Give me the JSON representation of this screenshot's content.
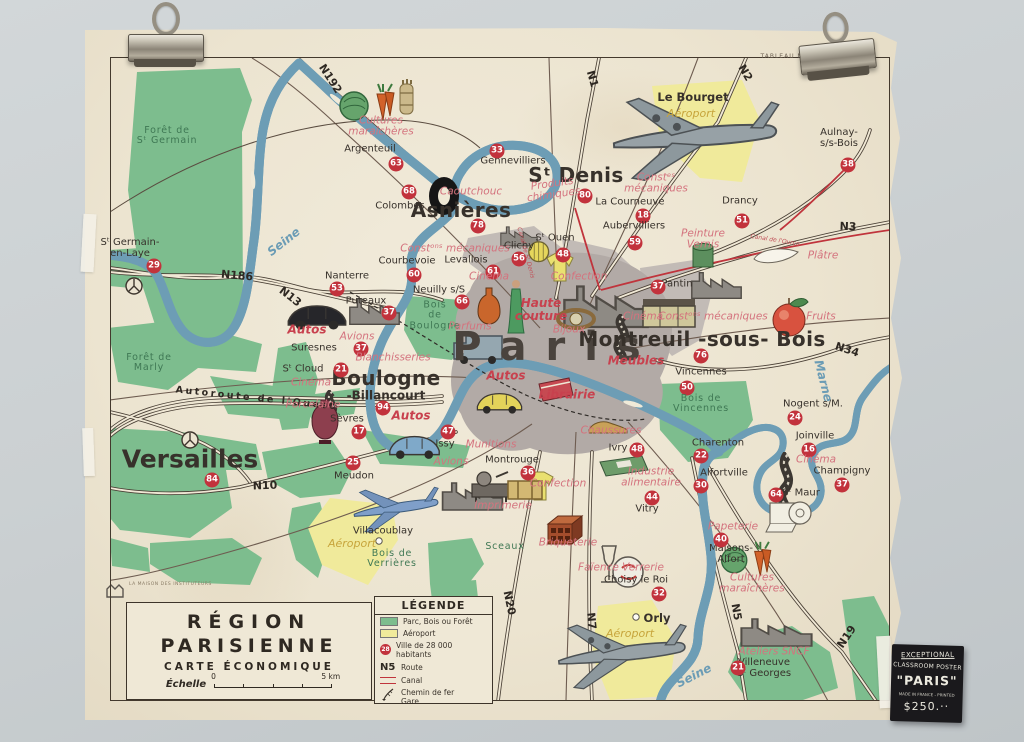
{
  "scene": {
    "wall_color": "#cbd0d2"
  },
  "poster": {
    "print_ref": "TABLEAU N° 22 —",
    "publisher": {
      "logo": "MDI",
      "name": "LA MAISON DES INSTITUTEURS"
    },
    "title_block": {
      "line1": "RÉGION",
      "line2": "PARISIENNE",
      "line3": "CARTE ÉCONOMIQUE",
      "scale_label": "Échelle",
      "scale_start": "0",
      "scale_end": "5 km"
    },
    "legend": {
      "title": "LÉGENDE",
      "park": "Parc, Bois ou Forêt",
      "airport": "Aéroport",
      "city_number": "28",
      "city": "Ville de 28 000 habitants",
      "route_symbol": "N5",
      "route": "Route",
      "canal": "Canal",
      "railway": "Chemin de fer",
      "station": "Gare"
    },
    "colors": {
      "park": "#7dbd8e",
      "airport": "#f0ea9b",
      "river": "#93c2d6",
      "canal": "#c0343c",
      "city_circle": "#c2323c",
      "industry_text": "#d4737e",
      "urban": "#b2aaa6"
    }
  },
  "price_tag": {
    "line1": "EXCEPTIONAL",
    "line2": "CLASSROOM POSTER",
    "line3": "\"PARIS\"",
    "line4": "MADE IN FRANCE - PRINTED",
    "line5": "$250.··"
  },
  "map": {
    "paris": "Paris",
    "cities": [
      {
        "name": "Versailles",
        "num": "84",
        "x": 190,
        "y": 459,
        "nx": 212,
        "ny": 480,
        "k": "xl"
      },
      {
        "name": "Asnières",
        "num": "78",
        "x": 461,
        "y": 211,
        "nx": 478,
        "ny": 226,
        "k": "lg"
      },
      {
        "name": "Sᵗ Denis",
        "num": "80",
        "x": 576,
        "y": 176,
        "nx": 585,
        "ny": 196,
        "k": "lg"
      },
      {
        "name": "Boulogne",
        "num": "94",
        "x": 386,
        "y": 379,
        "nx": 383,
        "ny": 408,
        "k": "lg"
      },
      {
        "name": "-Billancourt",
        "num": "",
        "x": 386,
        "y": 396,
        "nx": 0,
        "ny": 0,
        "k": "mdb"
      },
      {
        "name": "Montreuil -sous- Bois",
        "num": "76",
        "x": 702,
        "y": 340,
        "nx": 701,
        "ny": 356,
        "k": "lg"
      },
      {
        "name": "Le Bourget",
        "num": "",
        "x": 693,
        "y": 97,
        "nx": 0,
        "ny": 0,
        "k": "smb"
      },
      {
        "name": "Orly",
        "num": "",
        "x": 657,
        "y": 618,
        "nx": 0,
        "ny": 0,
        "k": "smb"
      },
      {
        "name": "Villacoublay",
        "num": "",
        "x": 383,
        "y": 532,
        "nx": 0,
        "ny": 0,
        "k": "sm"
      },
      {
        "name": "Argenteuil",
        "num": "63",
        "x": 370,
        "y": 150,
        "nx": 396,
        "ny": 164,
        "k": "sm"
      },
      {
        "name": "Colombes",
        "num": "68",
        "x": 400,
        "y": 207,
        "nx": 409,
        "ny": 192,
        "k": "sm"
      },
      {
        "name": "Gennevilliers",
        "num": "33",
        "x": 513,
        "y": 162,
        "nx": 497,
        "ny": 151,
        "k": "sm"
      },
      {
        "name": "La Courneuve",
        "num": "18",
        "x": 630,
        "y": 203,
        "nx": 643,
        "ny": 216,
        "k": "sm"
      },
      {
        "name": "Drancy",
        "num": "51",
        "x": 740,
        "y": 202,
        "nx": 742,
        "ny": 221,
        "k": "sm"
      },
      {
        "name": "Aubervilliers",
        "num": "59",
        "x": 634,
        "y": 227,
        "nx": 635,
        "ny": 243,
        "k": "sm"
      },
      {
        "name": "Aulnay-\ns/s-Bois",
        "num": "38",
        "x": 839,
        "y": 139,
        "nx": 848,
        "ny": 165,
        "k": "sm"
      },
      {
        "name": "Clichy",
        "num": "56",
        "x": 519,
        "y": 247,
        "nx": 519,
        "ny": 259,
        "k": "sm"
      },
      {
        "name": "Sᵗ Ouen",
        "num": "48",
        "x": 555,
        "y": 239,
        "nx": 563,
        "ny": 255,
        "k": "sm"
      },
      {
        "name": "Levallois",
        "num": "61",
        "x": 466,
        "y": 261,
        "nx": 493,
        "ny": 272,
        "k": "sm"
      },
      {
        "name": "Neuilly s/S",
        "num": "66",
        "x": 439,
        "y": 291,
        "nx": 462,
        "ny": 302,
        "k": "sm"
      },
      {
        "name": "Courbevoie",
        "num": "60",
        "x": 407,
        "y": 262,
        "nx": 414,
        "ny": 275,
        "k": "sm"
      },
      {
        "name": "Nanterre",
        "num": "53",
        "x": 347,
        "y": 277,
        "nx": 337,
        "ny": 289,
        "k": "sm"
      },
      {
        "name": "Sᵗ Germain-\nen-Laye",
        "num": "29",
        "x": 130,
        "y": 249,
        "nx": 154,
        "ny": 266,
        "k": "sm"
      },
      {
        "name": "Puteaux",
        "num": "37",
        "x": 366,
        "y": 302,
        "nx": 389,
        "ny": 313,
        "k": "sm"
      },
      {
        "name": "Suresnes",
        "num": "37",
        "x": 314,
        "y": 349,
        "nx": 361,
        "ny": 349,
        "k": "sm"
      },
      {
        "name": "Sᵗ Cloud",
        "num": "21",
        "x": 303,
        "y": 370,
        "nx": 341,
        "ny": 370,
        "k": "sm"
      },
      {
        "name": "Sèvres",
        "num": "17",
        "x": 347,
        "y": 420,
        "nx": 359,
        "ny": 432,
        "k": "sm"
      },
      {
        "name": "Meudon",
        "num": "25",
        "x": 354,
        "y": 477,
        "nx": 353,
        "ny": 463,
        "k": "sm"
      },
      {
        "name": "Issy",
        "num": "47",
        "x": 445,
        "y": 445,
        "nx": 448,
        "ny": 432,
        "k": "sm"
      },
      {
        "name": "Montrouge",
        "num": "36",
        "x": 512,
        "y": 461,
        "nx": 528,
        "ny": 473,
        "k": "sm"
      },
      {
        "name": "Ivry",
        "num": "48",
        "x": 618,
        "y": 449,
        "nx": 637,
        "ny": 450,
        "k": "sm"
      },
      {
        "name": "Vitry",
        "num": "44",
        "x": 647,
        "y": 510,
        "nx": 652,
        "ny": 498,
        "k": "sm"
      },
      {
        "name": "Choisy le Roi",
        "num": "32",
        "x": 636,
        "y": 581,
        "nx": 659,
        "ny": 594,
        "k": "sm"
      },
      {
        "name": "Charenton",
        "num": "22",
        "x": 718,
        "y": 444,
        "nx": 701,
        "ny": 456,
        "k": "sm"
      },
      {
        "name": "Alfortville",
        "num": "30",
        "x": 724,
        "y": 474,
        "nx": 701,
        "ny": 486,
        "k": "sm"
      },
      {
        "name": "Maisons-\nAlfort",
        "num": "40",
        "x": 731,
        "y": 555,
        "nx": 721,
        "ny": 540,
        "k": "sm"
      },
      {
        "name": "Sᵗ Maur",
        "num": "64",
        "x": 801,
        "y": 494,
        "nx": 776,
        "ny": 495,
        "k": "sm"
      },
      {
        "name": "Joinville",
        "num": "16",
        "x": 815,
        "y": 437,
        "nx": 809,
        "ny": 450,
        "k": "sm"
      },
      {
        "name": "Champigny",
        "num": "37",
        "x": 842,
        "y": 472,
        "nx": 842,
        "ny": 485,
        "k": "sm"
      },
      {
        "name": "Nogent s/M.",
        "num": "24",
        "x": 813,
        "y": 405,
        "nx": 795,
        "ny": 418,
        "k": "sm"
      },
      {
        "name": "Vincennes",
        "num": "50",
        "x": 701,
        "y": 373,
        "nx": 687,
        "ny": 388,
        "k": "sm"
      },
      {
        "name": "Pantin",
        "num": "37",
        "x": 677,
        "y": 285,
        "nx": 658,
        "ny": 287,
        "k": "sm"
      },
      {
        "name": "Villeneuve\nSᵗ Georges",
        "num": "21",
        "x": 764,
        "y": 669,
        "nx": 738,
        "ny": 668,
        "k": "sm"
      }
    ],
    "labels": [
      {
        "t": "N192",
        "k": "road",
        "x": 330,
        "y": 79,
        "r": 57
      },
      {
        "t": "N1",
        "k": "road",
        "x": 592,
        "y": 79,
        "r": 74
      },
      {
        "t": "N2",
        "k": "road",
        "x": 745,
        "y": 73,
        "r": 60
      },
      {
        "t": "N3",
        "k": "road",
        "x": 848,
        "y": 227,
        "r": 2
      },
      {
        "t": "N186",
        "k": "road",
        "x": 237,
        "y": 276,
        "r": 5
      },
      {
        "t": "N13",
        "k": "road",
        "x": 290,
        "y": 297,
        "r": 38
      },
      {
        "t": "Autoroute  de  l'Ouest",
        "k": "roadw",
        "x": 256,
        "y": 399,
        "r": 6
      },
      {
        "t": "N10",
        "k": "road",
        "x": 265,
        "y": 486,
        "r": -2
      },
      {
        "t": "N34",
        "k": "road",
        "x": 847,
        "y": 350,
        "r": 18
      },
      {
        "t": "N20",
        "k": "road",
        "x": 509,
        "y": 603,
        "r": 78
      },
      {
        "t": "N7",
        "k": "road",
        "x": 591,
        "y": 621,
        "r": 84
      },
      {
        "t": "N5",
        "k": "road",
        "x": 736,
        "y": 612,
        "r": 80
      },
      {
        "t": "N19",
        "k": "road",
        "x": 847,
        "y": 637,
        "r": -56
      },
      {
        "t": "Seine",
        "k": "water",
        "x": 284,
        "y": 242,
        "r": -38
      },
      {
        "t": "Seine",
        "k": "water",
        "x": 694,
        "y": 676,
        "r": -27
      },
      {
        "t": "Marne",
        "k": "water",
        "x": 823,
        "y": 381,
        "r": 76
      },
      {
        "t": "Canal de l'Ourcq",
        "k": "canal",
        "x": 775,
        "y": 241,
        "r": 9
      },
      {
        "t": "Canal de Sᵗ Denis",
        "k": "canal",
        "x": 525,
        "y": 253,
        "r": 75
      },
      {
        "t": "Forêt de\nSᵗ Germain",
        "k": "forest",
        "x": 167,
        "y": 136,
        "r": 0
      },
      {
        "t": "Forêt de\nMarly",
        "k": "forest",
        "x": 149,
        "y": 363,
        "r": 0
      },
      {
        "t": "Bois\nde\nBoulogne",
        "k": "forest",
        "x": 435,
        "y": 316,
        "r": 0
      },
      {
        "t": "Bois de\nVincennes",
        "k": "forest",
        "x": 701,
        "y": 404,
        "r": 0
      },
      {
        "t": "Bois de\nVerrières",
        "k": "forest",
        "x": 392,
        "y": 559,
        "r": 0
      },
      {
        "t": "Sceaux",
        "k": "forest",
        "x": 505,
        "y": 547,
        "r": 0
      },
      {
        "t": "Aéroport",
        "k": "air",
        "x": 691,
        "y": 114,
        "r": 0
      },
      {
        "t": "Aéroport",
        "k": "air",
        "x": 352,
        "y": 544,
        "r": 0
      },
      {
        "t": "Aéroport",
        "k": "air",
        "x": 630,
        "y": 634,
        "r": 0
      },
      {
        "t": "Cultures\nmaraîchères",
        "k": "ind",
        "x": 381,
        "y": 127,
        "r": 0
      },
      {
        "t": "Caoutchouc",
        "k": "ind",
        "x": 471,
        "y": 192,
        "r": 0
      },
      {
        "t": "Produits\nchimiques",
        "k": "ind",
        "x": 553,
        "y": 190,
        "r": -8
      },
      {
        "t": "Constᵉˢ\nmécaniques",
        "k": "ind",
        "x": 656,
        "y": 184,
        "r": 0
      },
      {
        "t": "Peinture\nVernis",
        "k": "ind",
        "x": 703,
        "y": 240,
        "r": 0
      },
      {
        "t": "Plâtre",
        "k": "ind",
        "x": 823,
        "y": 256,
        "r": 0
      },
      {
        "t": "Constᵒⁿˢ mécaniques",
        "k": "ind",
        "x": 455,
        "y": 249,
        "r": 0
      },
      {
        "t": "Cinéma",
        "k": "ind",
        "x": 489,
        "y": 277,
        "r": 0
      },
      {
        "t": "Confection",
        "k": "ind",
        "x": 579,
        "y": 277,
        "r": 0
      },
      {
        "t": "Haute\ncouture",
        "k": "indb",
        "x": 541,
        "y": 310,
        "r": 0
      },
      {
        "t": "Bijoux",
        "k": "ind",
        "x": 569,
        "y": 330,
        "r": 0
      },
      {
        "t": "Parfums",
        "k": "ind",
        "x": 470,
        "y": 327,
        "r": 0
      },
      {
        "t": "Meubles",
        "k": "indb",
        "x": 636,
        "y": 361,
        "r": 0
      },
      {
        "t": "Cinéma",
        "k": "ind",
        "x": 643,
        "y": 317,
        "r": 0
      },
      {
        "t": "Constᵒⁿˢ mécaniques",
        "k": "ind",
        "x": 713,
        "y": 317,
        "r": 0
      },
      {
        "t": "Fruits",
        "k": "ind",
        "x": 821,
        "y": 317,
        "r": 0
      },
      {
        "t": "Autos",
        "k": "indb",
        "x": 307,
        "y": 330,
        "r": 0
      },
      {
        "t": "Avions",
        "k": "ind",
        "x": 357,
        "y": 337,
        "r": 0
      },
      {
        "t": "Blanchisseries",
        "k": "ind",
        "x": 393,
        "y": 358,
        "r": 0
      },
      {
        "t": "Cinéma",
        "k": "ind",
        "x": 311,
        "y": 383,
        "r": 0
      },
      {
        "t": "Autos",
        "k": "indb",
        "x": 506,
        "y": 376,
        "r": 0
      },
      {
        "t": "Librairie",
        "k": "indb",
        "x": 567,
        "y": 395,
        "r": 0
      },
      {
        "t": "Porcelaine",
        "k": "ind",
        "x": 313,
        "y": 405,
        "r": 0
      },
      {
        "t": "Autos",
        "k": "indb",
        "x": 411,
        "y": 416,
        "r": 0
      },
      {
        "t": "Chaussures",
        "k": "ind",
        "x": 611,
        "y": 431,
        "r": 0
      },
      {
        "t": "Munitions",
        "k": "ind",
        "x": 491,
        "y": 445,
        "r": 0
      },
      {
        "t": "Avions",
        "k": "ind",
        "x": 451,
        "y": 462,
        "r": 0
      },
      {
        "t": "Confection",
        "k": "ind",
        "x": 558,
        "y": 484,
        "r": 0
      },
      {
        "t": "Imprimerie",
        "k": "ind",
        "x": 503,
        "y": 506,
        "r": 0
      },
      {
        "t": "Industrie\nalimentaire",
        "k": "ind",
        "x": 651,
        "y": 478,
        "r": 0
      },
      {
        "t": "Briqueterie",
        "k": "ind",
        "x": 568,
        "y": 543,
        "r": 0
      },
      {
        "t": "Faïence Verrerie",
        "k": "ind",
        "x": 621,
        "y": 568,
        "r": 0
      },
      {
        "t": "Papeterie",
        "k": "ind",
        "x": 733,
        "y": 527,
        "r": 0
      },
      {
        "t": "Cinéma",
        "k": "ind",
        "x": 816,
        "y": 460,
        "r": 0
      },
      {
        "t": "Cultures\nmaraîchères",
        "k": "ind",
        "x": 752,
        "y": 584,
        "r": 0
      },
      {
        "t": "Ateliers SNCF",
        "k": "ind",
        "x": 774,
        "y": 652,
        "r": 0
      },
      {
        "t": "TABLEAU N° 22 —",
        "k": "tiny",
        "x": 795,
        "y": 57,
        "r": 0
      }
    ]
  }
}
